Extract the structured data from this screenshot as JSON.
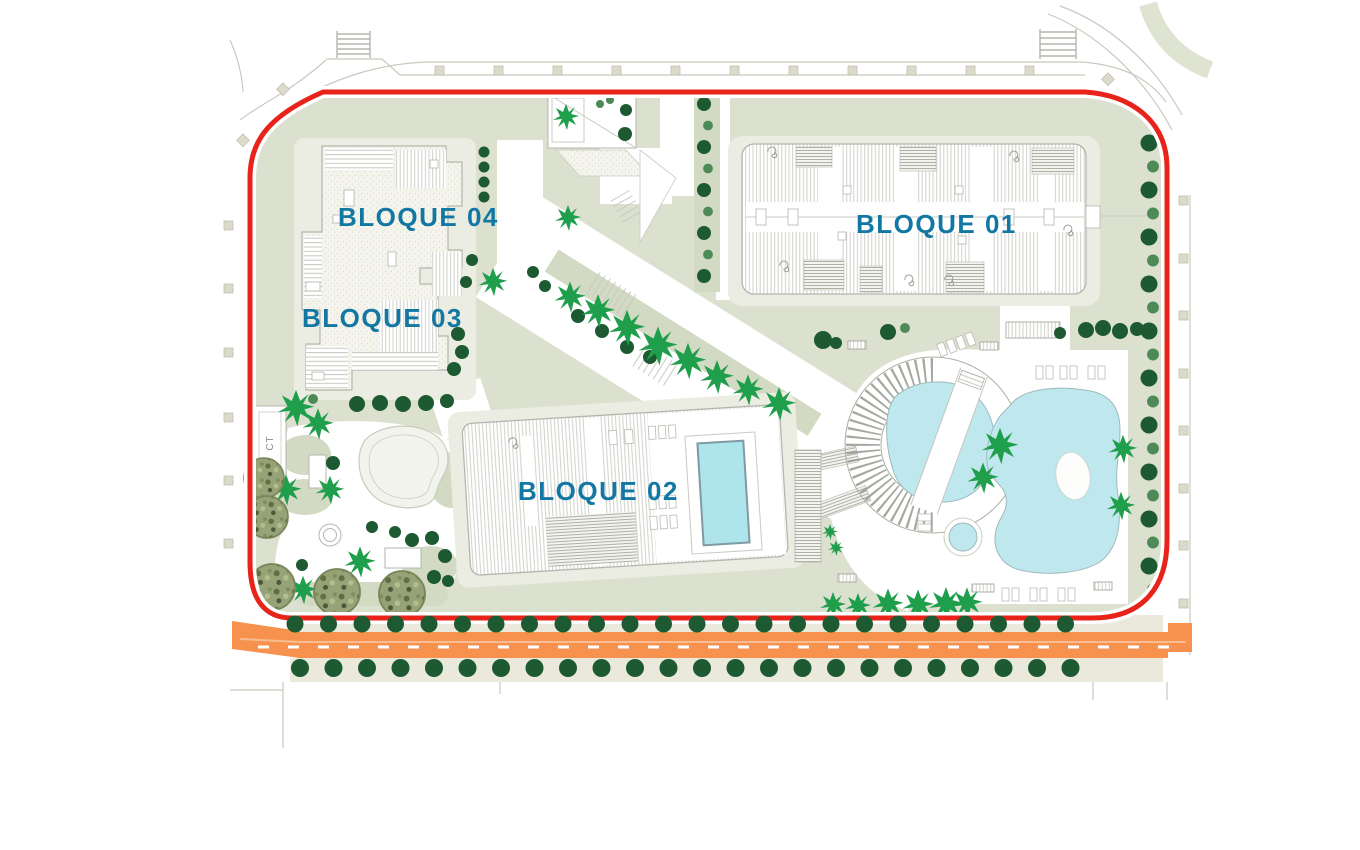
{
  "plan": {
    "labels": {
      "bloque01": "BLOQUE 01",
      "bloque02": "BLOQUE 02",
      "bloque03": "BLOQUE 03",
      "bloque04": "BLOQUE 04",
      "ct": "CT"
    },
    "colors": {
      "boundary_red": "#e8231a",
      "label_blue": "#1377a3",
      "landscape_sage": "#dbe0cf",
      "landscape_sage_dark": "#d3dac3",
      "paving_light": "#ecede2",
      "pool_cyan": "#bfe8ee",
      "rooftop_pool_cyan": "#aee4ec",
      "road_orange": "#f6924d",
      "road_stripe": "#f8bd92",
      "tree_dark": "#1d5a32",
      "tree_medium": "#4e8a57",
      "palm_green": "#1f9e4b",
      "sidewalk_beige": "#eae9dc",
      "marker_beige": "#dcdaca"
    },
    "tree_rows": {
      "road_top": {
        "count": 24,
        "start_x": 295,
        "spacing": 33.5,
        "y": 624,
        "r": 8.5
      },
      "road_bottom": {
        "count": 24,
        "start_x": 300,
        "spacing": 33.5,
        "y": 668,
        "r": 9
      },
      "right_column": {
        "count": 20,
        "x": 1151,
        "start_y": 143,
        "spacing": 23.5,
        "r": 8.5,
        "alt": true
      },
      "center_column": {
        "count": 9,
        "x": 706,
        "start_y": 104,
        "spacing": 21.5,
        "r": 7,
        "alt": true
      }
    }
  }
}
